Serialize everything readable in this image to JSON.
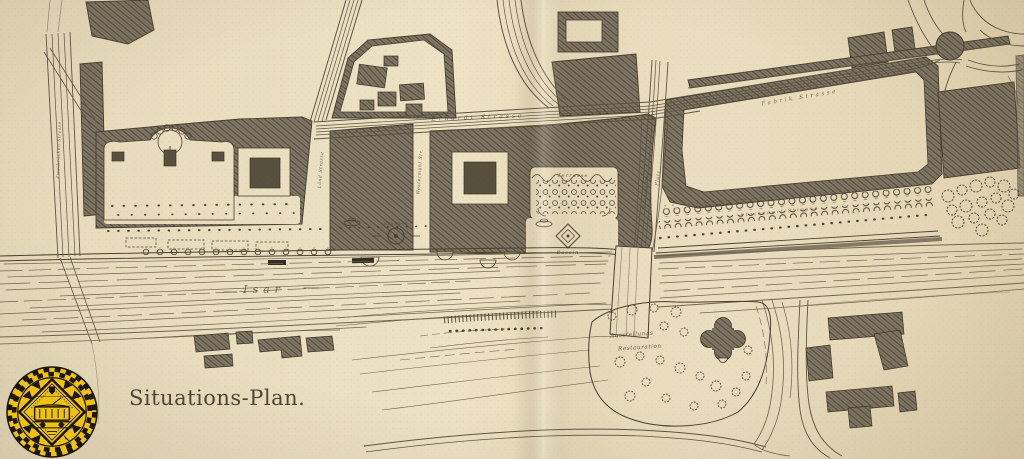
{
  "page": {
    "caption": "Situations-Plan."
  },
  "map": {
    "river_label": "Isar",
    "labels": {
      "terrasse": "Terrasse",
      "bassin": "Bassin",
      "brunnen": "Brunnen",
      "ausstellung_line1": "Ausstellungs",
      "ausstellung_line2": "Restauration",
      "street_top": "Erhardt Strasse",
      "street_right_diagonal": "Fabrik Strasse",
      "street_promenade": "Steinsdorf Strasse",
      "street_left_vertical": "Zweibrücken Strasse",
      "street_laend": "Länd Strasse",
      "street_westermuehl": "Westermühl Str.",
      "street_museums": "Museums Str.",
      "platz": "Platz"
    }
  },
  "seal": {
    "yellow": "#efc20e",
    "black": "#191309"
  }
}
